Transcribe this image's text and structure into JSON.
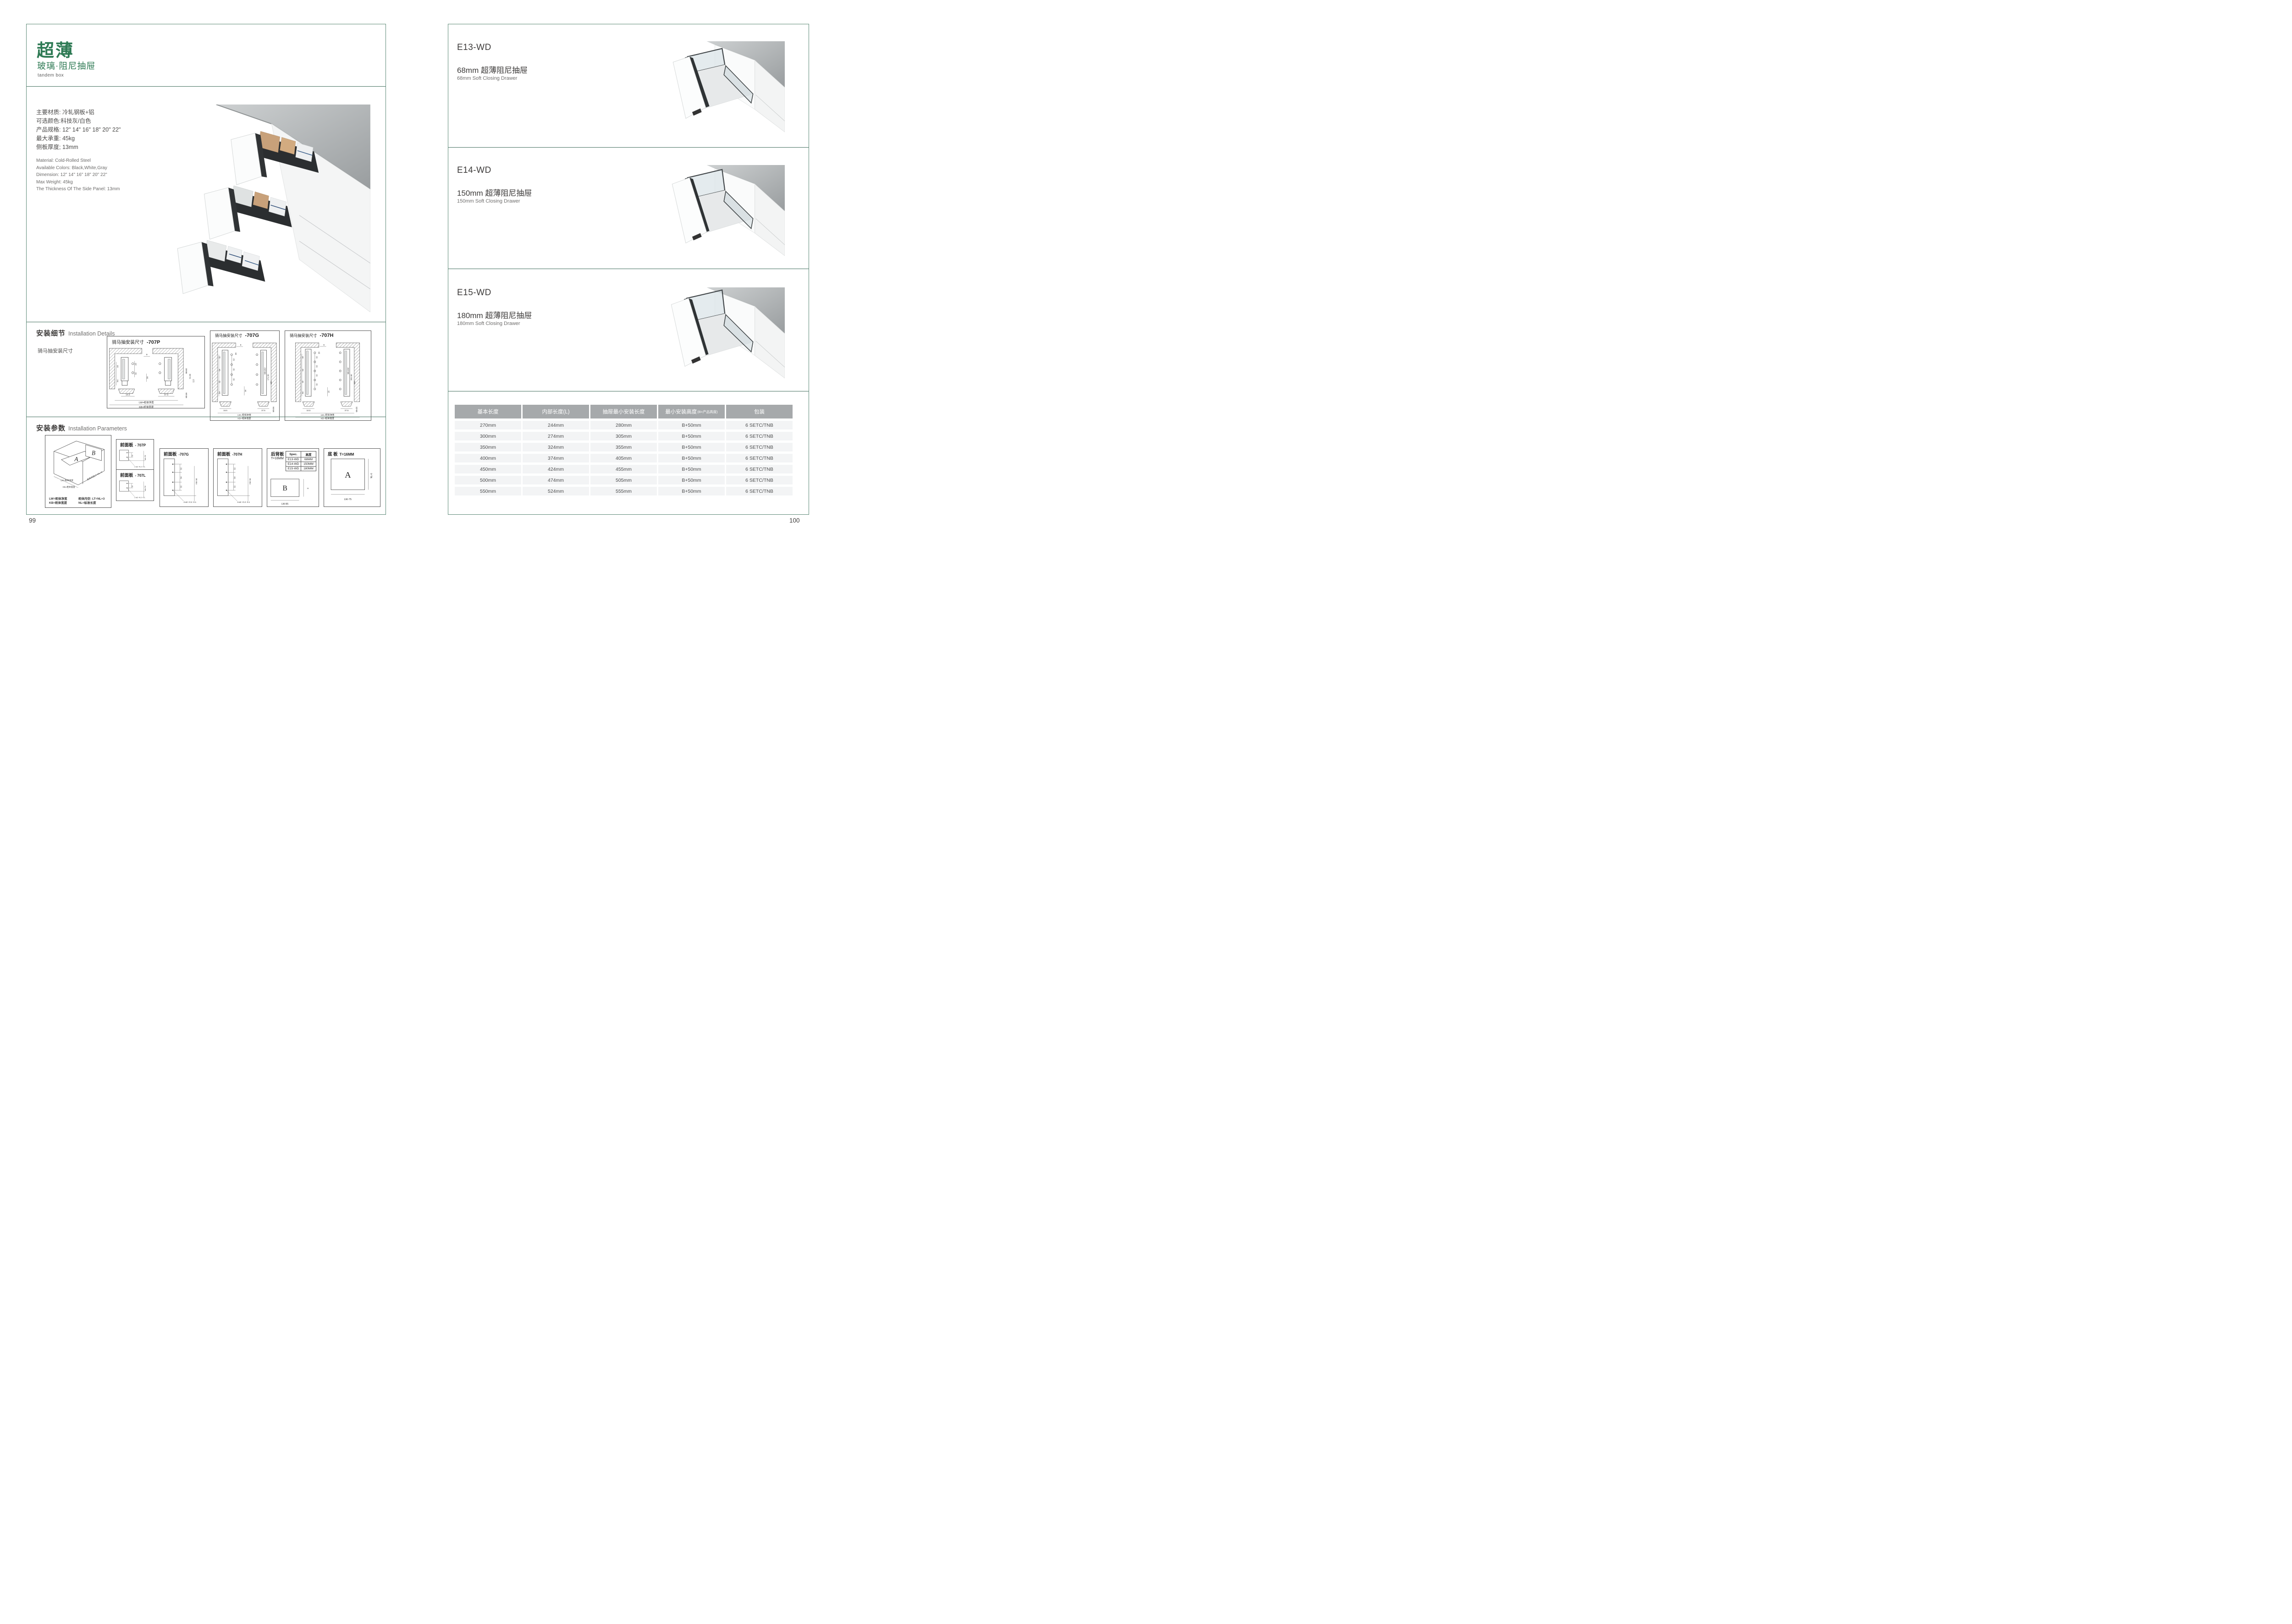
{
  "colors": {
    "accent_green": "#2e7a54",
    "line_green": "#44705f",
    "table_header_bg": "#a6a9ab",
    "table_row_bg": "#f3f4f5",
    "counter_gray": "#b4b8b9"
  },
  "page_left": {
    "page_number": "99",
    "title": "超薄",
    "subtitle": "玻璃·阻尼抽屉",
    "tagline": "tandem box",
    "specs_cn": [
      "主要材质: 冷轧钢板+铝",
      "可选颜色:科技灰/白色",
      "产品规格: 12\" 14\" 16\" 18\" 20\" 22\"",
      "最大承重: 45kg",
      "侧板厚度; 13mm"
    ],
    "specs_en": [
      "Material: Cold-Rolled Steel",
      "Available Colors: Black,White,Gray",
      "Dimension: 12\" 14\" 16\" 18\" 20\" 22\"",
      "Max Weight: 45kg",
      "The Thickness Of The Side Panel: 13mm"
    ],
    "details": {
      "heading_cn": "安装细节",
      "heading_en": "Installation Details",
      "subheading": "骑马抽安装尺寸",
      "drawings": [
        {
          "title": "骑马抽安装尺寸",
          "code": "-707P",
          "dims": {
            "d9": "9",
            "d20": "20",
            "d32r": "32",
            "d16": "16",
            "d32l": "32",
            "d54": "54",
            "bl": "16.5",
            "br": "37.5",
            "m1": "Min82",
            "m2": "91.50",
            "m3": "113",
            "m4": "Min36",
            "lw": "LW=柜体净宽",
            "kb": "KB=柜体宽度"
          }
        },
        {
          "title": "骑马抽安装尺寸",
          "code": "-707G",
          "dims": {
            "d9": "9",
            "d20": "20",
            "p1": "32",
            "p2": "32",
            "p3": "32",
            "d16": "16",
            "l1": "32",
            "l2": "64",
            "l3": "32",
            "l4": "54",
            "bl": "16.5",
            "br": "37.5",
            "m1": "Min162",
            "m2": "171.50",
            "m3": "195",
            "m4": "Min36",
            "lw": "LW=柜体净宽",
            "kb": "KB=柜体宽度"
          }
        },
        {
          "title": "骑马抽安装尺寸",
          "code": "-707H",
          "dims": {
            "d9": "9",
            "d20": "20",
            "p1": "32",
            "p2": "32",
            "p3": "32",
            "p4": "32",
            "d16": "16",
            "l1": "32",
            "l2": "64",
            "l3": "32",
            "l4": "54",
            "bl": "16.5",
            "br": "37.5",
            "m1": "Min192",
            "m2": "201.50",
            "m3": "225",
            "m4": "Min36",
            "lw": "LW=柜体净宽",
            "kb": "KB=柜体宽度"
          }
        }
      ]
    },
    "parameters": {
      "heading_cn": "安装参数",
      "heading_en": "Installation Parameters",
      "iso": {
        "label_a": "A",
        "label_b": "B",
        "dim_lw": "LW=柜体净宽",
        "dim_kb": "KB=柜体宽度",
        "dim_lt": "柜体内空LT=NL+3",
        "legend": [
          "LW=柜体净宽",
          "柜体内空: LT=NL+3",
          "KB=柜体宽度",
          "NL=标准长度"
        ]
      },
      "front_panels": [
        {
          "title": "前面板",
          "code": "- 707P",
          "d32": "32",
          "dmin": "min 54",
          "dhole": "2-ø2 +0.2 -0.1"
        },
        {
          "title": "前面板",
          "code": "- 707L",
          "d32": "32",
          "dmin": "min 54",
          "dhole": "2-ø2 +0.2 -0.1"
        },
        {
          "title": "前面板",
          "code": "-707G",
          "d32a": "32",
          "d64": "64",
          "d32b": "32",
          "dmin": "min 54",
          "dhole": "4-ø2 +0.2 -0.1"
        },
        {
          "title": "前面板",
          "code": "-707H",
          "d32a": "32",
          "d64": "64",
          "d32b": "32",
          "dmin": "min 54",
          "dhole": "4-ø2 +0.2 -0.1"
        }
      ],
      "rear_panel": {
        "title": "后背板",
        "thickness": "T=16MM",
        "spec_headers": [
          "Spec.",
          "高度"
        ],
        "spec_rows": [
          [
            "E13-WD",
            "68MM"
          ],
          [
            "E14-WD",
            "150MM"
          ],
          [
            "E15-WD",
            "180MM"
          ]
        ],
        "label": "B",
        "dim_h": "H",
        "dim_w": "LW-85"
      },
      "bottom_panel": {
        "title": "底 板",
        "thickness": "T=16MM",
        "label": "A",
        "dim_h": "NL-6",
        "dim_w": "LW-75"
      }
    }
  },
  "page_right": {
    "page_number": "100",
    "products": [
      {
        "code": "E13-WD",
        "name_cn": "68mm 超薄阻尼抽屉",
        "name_en": "68mm Soft Closing Drawer"
      },
      {
        "code": "E14-WD",
        "name_cn": "150mm 超薄阻尼抽屉",
        "name_en": "150mm Soft Closing Drawer"
      },
      {
        "code": "E15-WD",
        "name_cn": "180mm 超薄阻尼抽屉",
        "name_en": "180mm Soft Closing Drawer"
      }
    ],
    "table": {
      "headers": [
        "基本长度",
        "内部长度(L)",
        "抽屉最小安装长度",
        "最小安装高度",
        "包装"
      ],
      "header_sub": "(B=产品高度)",
      "rows": [
        [
          "270mm",
          "244mm",
          "280mm",
          "B+50mm",
          "6 SETC/TNB"
        ],
        [
          "300mm",
          "274mm",
          "305mm",
          "B+50mm",
          "6 SETC/TNB"
        ],
        [
          "350mm",
          "324mm",
          "355mm",
          "B+50mm",
          "6 SETC/TNB"
        ],
        [
          "400mm",
          "374mm",
          "405mm",
          "B+50mm",
          "6 SETC/TNB"
        ],
        [
          "450mm",
          "424mm",
          "455mm",
          "B+50mm",
          "6 SETC/TNB"
        ],
        [
          "500mm",
          "474mm",
          "505mm",
          "B+50mm",
          "6 SETC/TNB"
        ],
        [
          "550mm",
          "524mm",
          "555mm",
          "B+50mm",
          "6 SETC/TNB"
        ]
      ]
    }
  }
}
